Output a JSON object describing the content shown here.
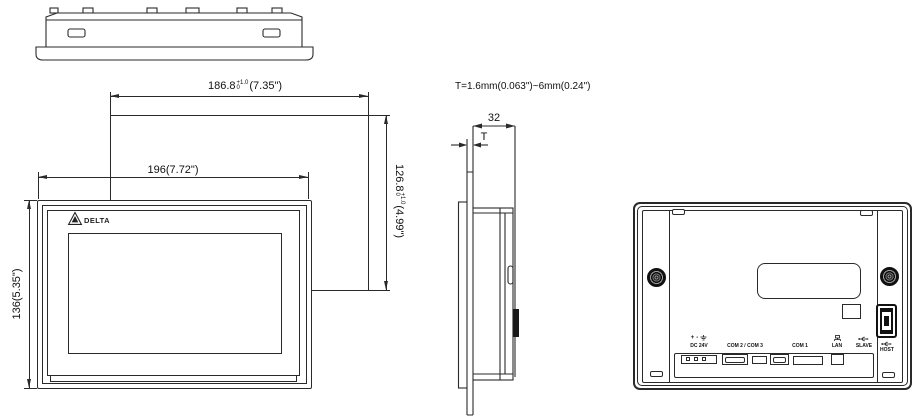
{
  "drawing": {
    "thickness_note": "T=1.6mm(0.063\")~6mm(0.24\")",
    "front": {
      "brand": "DELTA",
      "outer_width": "196(7.72\")",
      "outer_height": "136(5.35\")",
      "cutout_width": {
        "value": "186.8",
        "tol_upper": "+1.0",
        "tol_lower": "0",
        "inch": "(7.35\")"
      },
      "cutout_height": {
        "value": "126.8",
        "tol_upper": "+1.0",
        "tol_lower": "0",
        "inch": "(4.99\")"
      }
    },
    "side": {
      "depth": "32",
      "panel_thickness": "T"
    },
    "rear": {
      "power_plus": "+",
      "power_minus": "-",
      "labels": {
        "dc": "DC 24V",
        "com23": "COM 2 / COM 3",
        "com1": "COM 1",
        "lan": "LAN",
        "slave": "SLAVE",
        "host": "HOST"
      }
    },
    "colors": {
      "line": "#2a2a2a",
      "background": "#ffffff"
    }
  }
}
